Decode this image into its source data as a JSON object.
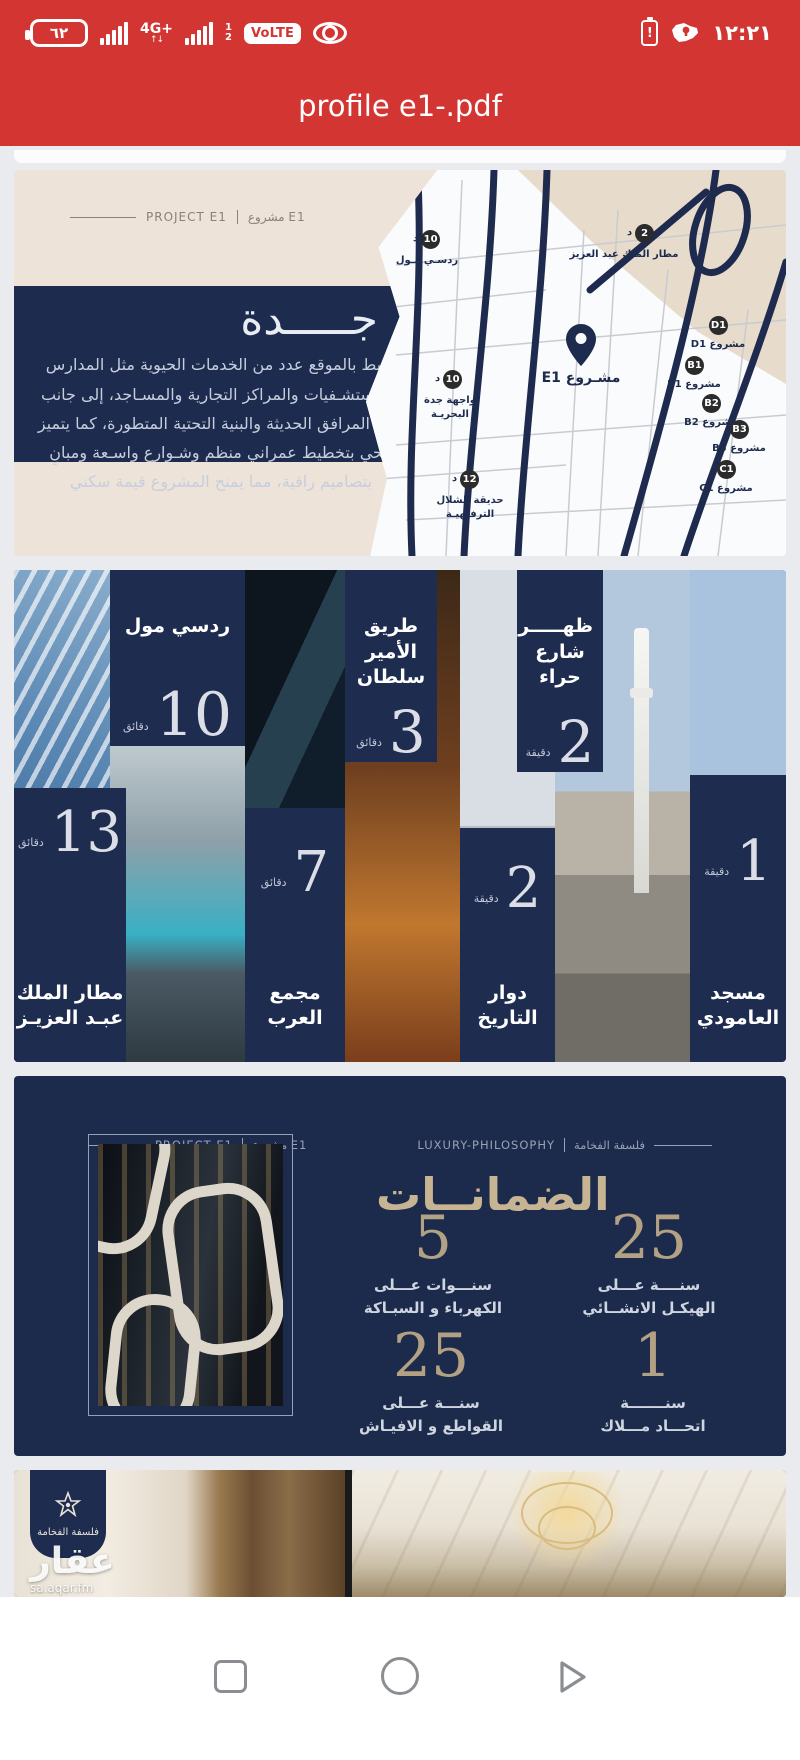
{
  "status_bar": {
    "battery_percent": "٦٢",
    "network_badge": "4G+",
    "network_arrows": "↑↓",
    "sim1_label": "1",
    "sim2_label": "2",
    "volte_label": "VoLTE",
    "alert_mark": "!",
    "time": "١٢:٢١"
  },
  "title_bar": {
    "title": "profile e1-.pdf"
  },
  "page1": {
    "tag_en": "PROJECT E1",
    "tag_ar": "مشروع E1",
    "city_title": "جـــــدة",
    "about": "يحيط بالموقع عدد من الخدمات الحيوية مثل المدارس والمستشـفيات والمراكز التجارية والمسـاجد، إلى جانب توفر المرافق الحديثة والبنية التحتية المتطورة، كما يتميز الحي بتخطيط عمراني منظم وشـوارع واسـعة ومبانٍ بتصاميم راقية، مما يمنح المشروع قيمة سكني",
    "map": {
      "project_pin_label": "مشـروع E1",
      "pins": [
        {
          "value": "10",
          "unit": "د",
          "label": "ردسـي مـول"
        },
        {
          "value": "2",
          "unit": "د",
          "label": "مطار الملك عبد العزيز"
        },
        {
          "value": "10",
          "unit": "د",
          "label": "واجهة جدة البحريـة"
        },
        {
          "value": "12",
          "unit": "د",
          "label": "حديقة الشلال الترفيهيـة"
        },
        {
          "value": "D1",
          "unit": "",
          "label": "مشروع D1"
        },
        {
          "value": "B1",
          "unit": "",
          "label": "مشروع B1"
        },
        {
          "value": "B2",
          "unit": "",
          "label": "مشروع B2"
        },
        {
          "value": "B3",
          "unit": "",
          "label": "مشروع B3"
        },
        {
          "value": "C1",
          "unit": "",
          "label": "مشروع C1"
        }
      ]
    }
  },
  "page2": {
    "locations": [
      {
        "name": "ردسي مول",
        "value": "10",
        "unit": "دقائق"
      },
      {
        "name": "طريق الأمير سلطان",
        "value": "3",
        "unit": "دقائق"
      },
      {
        "name": "ظهـــــر شارع حراء",
        "value": "2",
        "unit": "دقيقة"
      },
      {
        "name": "مطار الملك عبـد العزيـز",
        "value": "13",
        "unit": "دقائق"
      },
      {
        "name": "مجمع العرب",
        "value": "7",
        "unit": "دقائق"
      },
      {
        "name": "دوار التاريخ",
        "value": "2",
        "unit": "دقيقة"
      },
      {
        "name": "مسجد العامودي",
        "value": "1",
        "unit": "دقيقة"
      }
    ]
  },
  "page3": {
    "tag_left_en": "PROJECT E1",
    "tag_left_ar": "مشروع E1",
    "tag_right_en": "LUXURY-PHILOSOPHY",
    "tag_right_ar": "فلسفة الفخامة",
    "title": "الضمانــات",
    "guarantees": [
      {
        "value": "25",
        "line1": "سنــــة عـــلى",
        "line2": "الهيكـل الانشــائي"
      },
      {
        "value": "5",
        "line1": "سنـــوات عـــلى",
        "line2": "الكهرباء و السبـاكة"
      },
      {
        "value": "1",
        "line1": "سنـــــــة",
        "line2": "اتحـــاد مـــلاك"
      },
      {
        "value": "25",
        "line1": "سنـــة عـــلى",
        "line2": "القواطع و الافيـاش"
      }
    ]
  },
  "page4": {
    "logo_text": "فلسفة الفخامة",
    "watermark": "عقار",
    "watermark_domain": "sa.aqar.fm"
  },
  "colors": {
    "accent_red": "#d23532",
    "navy": "#1d2b4e",
    "beige_page": "#ede3d9",
    "gold": "#b2a183"
  }
}
